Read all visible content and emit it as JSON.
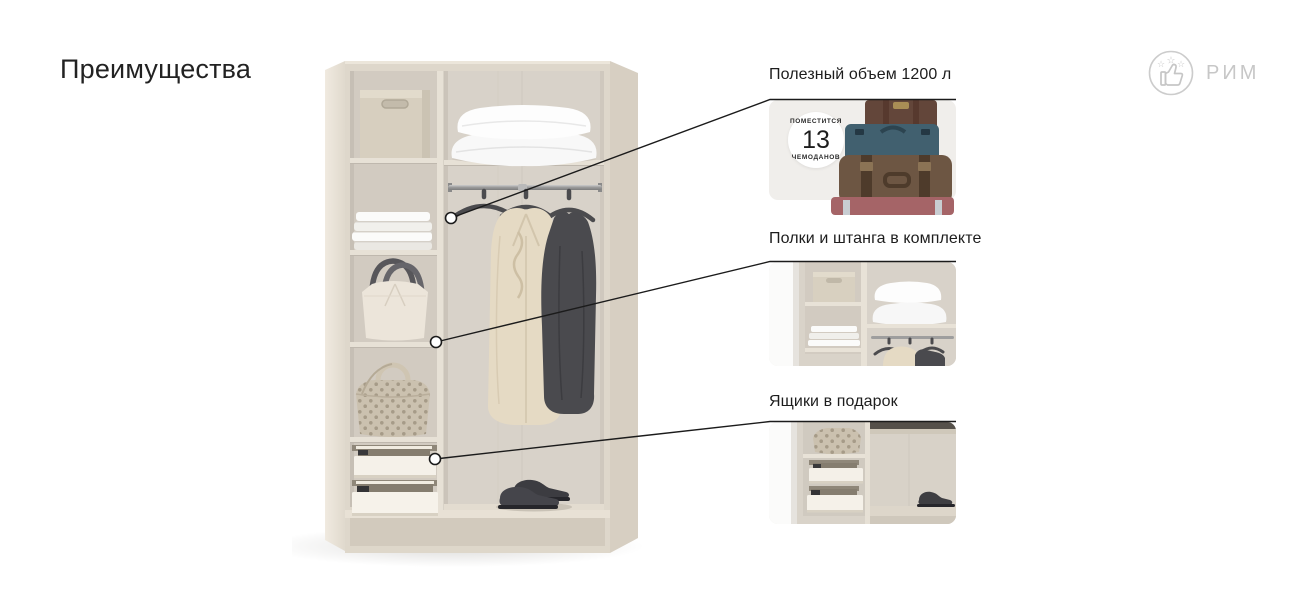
{
  "page": {
    "title": "Преимущества"
  },
  "brand": {
    "name": "РИМ",
    "icon": "thumbs-up-with-stars-icon",
    "color": "#c7c7c7"
  },
  "callouts": [
    {
      "id": "useful-volume",
      "label": "Полезный объем 1200 л",
      "thumbnail": "stack-of-suitcases",
      "badge": {
        "line1": "ПОМЕСТИТСЯ",
        "number": "13",
        "line2": "ЧЕМОДАНОВ"
      }
    },
    {
      "id": "shelves-and-rod",
      "label": "Полки и штанга в комплекте",
      "thumbnail": "wardrobe-interior-shelves-rod-closeup"
    },
    {
      "id": "drawers-gift",
      "label": "Ящики в подарок",
      "thumbnail": "open-drawers-closeup"
    }
  ],
  "colors": {
    "text": "#1e1e1e",
    "leader_line": "#1b1b1b",
    "card_background": "#f0eeeb",
    "wardrobe_beige": "#ded7cb",
    "brand_gray": "#c7c7c7"
  }
}
